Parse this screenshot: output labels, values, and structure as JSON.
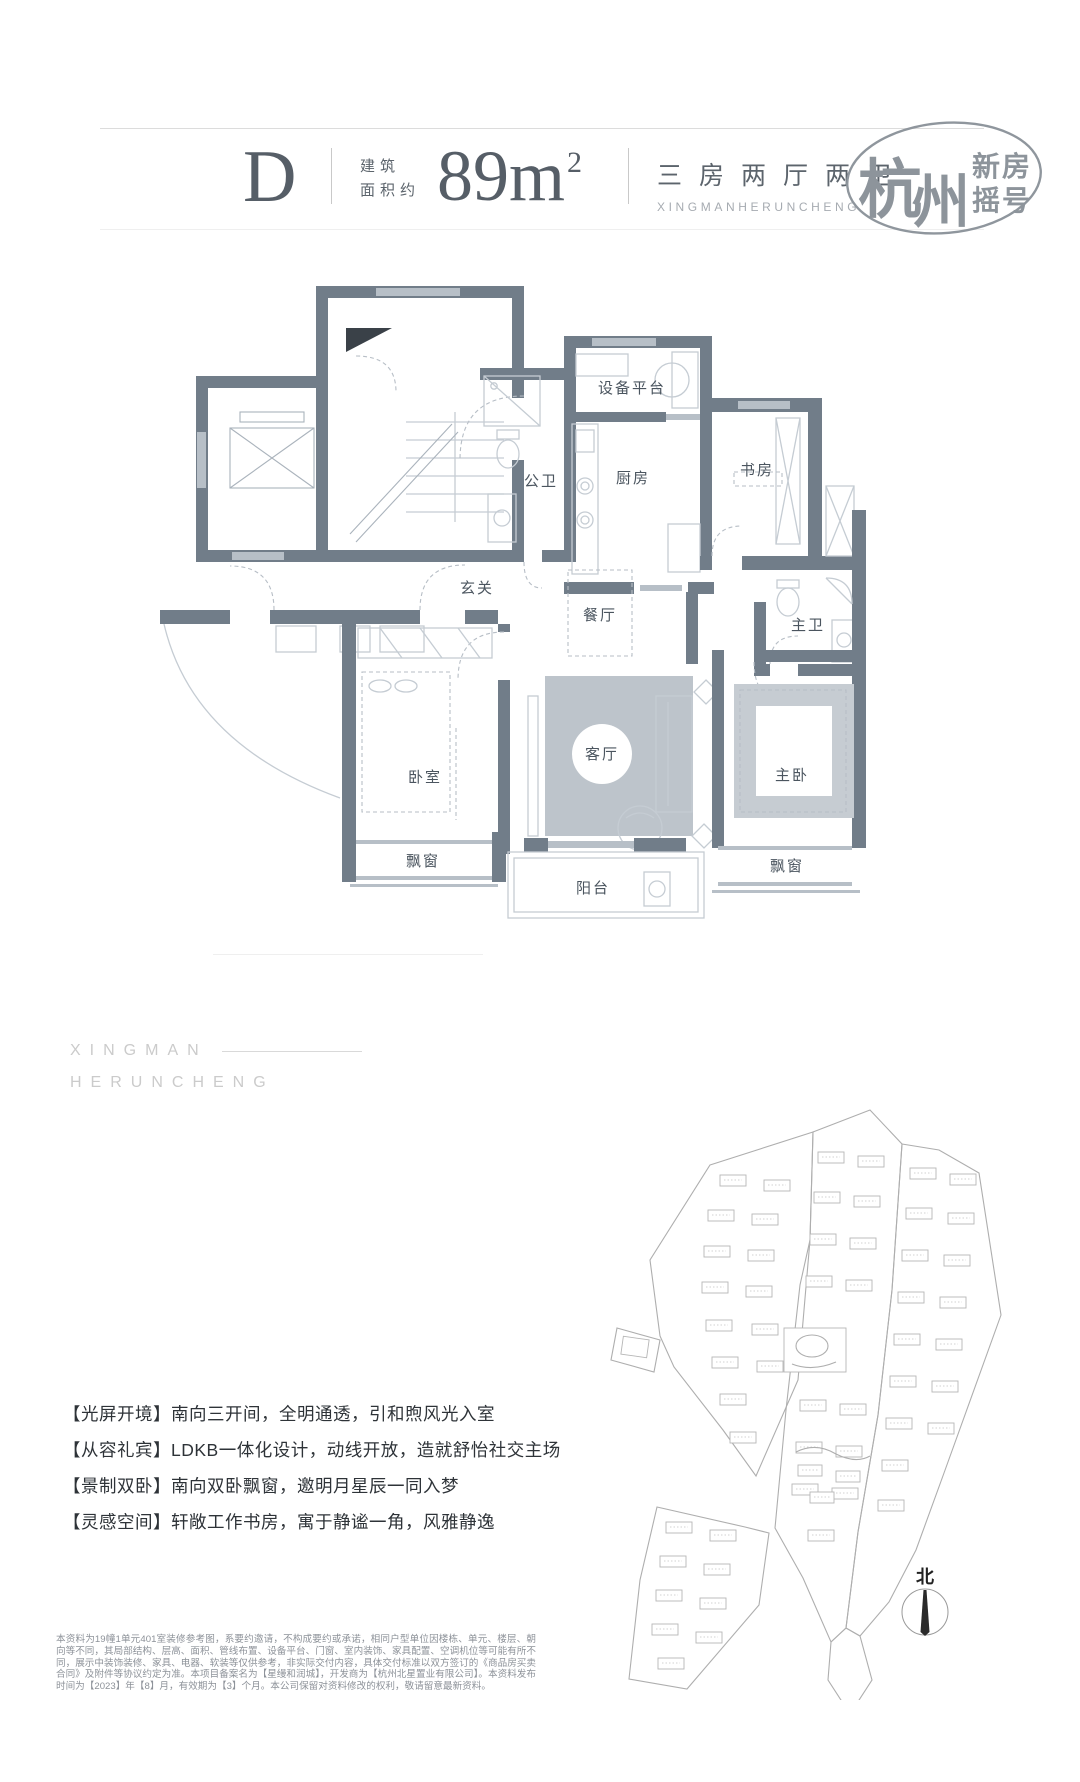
{
  "header": {
    "unit": "D",
    "area_label_line1": "建筑",
    "area_label_line2": "面积约",
    "area_value": "89m",
    "area_sup": "2",
    "layout_cn": "三房两厅两卫",
    "layout_en": "XINGMANHERUNCHENG",
    "logo": {
      "city_char1": "杭",
      "city_char2": "州",
      "line1": "新房",
      "line2": "摇号"
    }
  },
  "floorplan": {
    "rooms": [
      {
        "label": "设备平台"
      },
      {
        "label": "公卫"
      },
      {
        "label": "厨房"
      },
      {
        "label": "书房"
      },
      {
        "label": "玄关"
      },
      {
        "label": "餐厅"
      },
      {
        "label": "主卫"
      },
      {
        "label": "卧室"
      },
      {
        "label": "客厅"
      },
      {
        "label": "主卧"
      },
      {
        "label": "飘窗"
      },
      {
        "label": "飘窗"
      },
      {
        "label": "阳台"
      }
    ]
  },
  "brand": {
    "line1": "XINGMAN",
    "line2": "HERUNCHENG"
  },
  "features": [
    {
      "text": "【光屏开境】南向三开间，全明通透，引和煦风光入室"
    },
    {
      "text": "【从容礼宾】LDKB一体化设计，动线开放，造就舒怡社交主场"
    },
    {
      "text": "【景制双卧】南向双卧飘窗，邀明月星辰一同入梦"
    },
    {
      "text": "【灵感空间】轩敞工作书房，寓于静谧一角，风雅静逸"
    }
  ],
  "siteplan": {
    "north_label": "北"
  },
  "disclaimer": "本资料为19幢1单元401室装修参考图，系要约邀请，不构成要约或承诺，相同户型单位因楼栋、单元、楼层、朝向等不同，其局部结构、层高、面积、管线布置、设备平台、门窗、室内装饰、家具配置、空调机位等可能有所不同，展示中装饰装修、家具、电器、软装等仅供参考，非实际交付内容，具体交付标准以双方签订的《商品房买卖合同》及附件等协议约定为准。本项目备案名为【星缦和润城】，开发商为【杭州北星置业有限公司】。本资料发布时间为【2023】年【8】月，有效期为【3】个月。本公司保留对资料修改的权利，敬请留意最新资料。"
}
